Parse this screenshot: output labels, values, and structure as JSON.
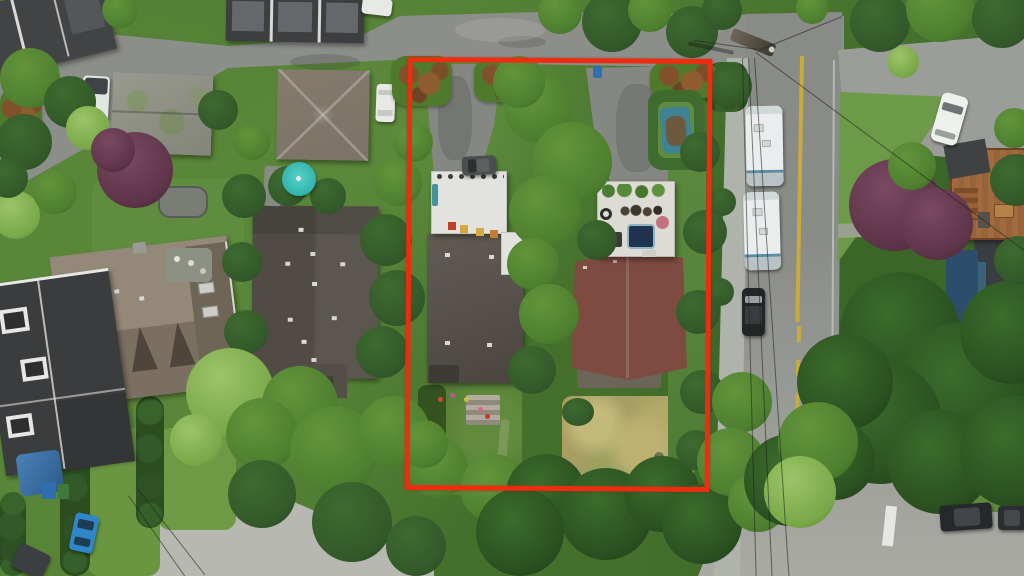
{
  "image": {
    "type": "aerial-drone-photograph",
    "subject": "residential lot assembly outlined in red, two houses with driveways, bordered by a street with parked RVs",
    "visible_text": "none"
  },
  "annotation": {
    "label": "property-boundary",
    "shape": "rectangle",
    "color": "#ee2d10",
    "x": 406,
    "y": 58,
    "width": 305,
    "height": 433
  },
  "palette": {
    "boundary": "#ee2d10",
    "roadTop": "#8c8e8a",
    "roadSide": "#979994",
    "concreteLane": "#b6b8b1",
    "sidewalk": "#b0b3ac",
    "parking": "#9b9d98",
    "yellowLine": "#c9aa3f",
    "asphaltDrive": "#858783",
    "whiteRoof": "#e2e3df",
    "deckWhite": "#dcdbd4",
    "leftHouseRoof": "#59534d",
    "rightHouseRoof": "#7d4b40",
    "neighborBigRoof": "#544f48",
    "steepRoof": "#948878",
    "modernBlackRoof": "#3a3c3d",
    "mossyRoof": "#8f9086",
    "pyramidRoof": "#7b7365",
    "navyWall": "#2d4d6d",
    "woodDeck": "#a26b3e",
    "rvWhite": "#e9edee",
    "grass": "#577f36",
    "dryLawn": "#a89e62",
    "treeDark": "#33592a",
    "treeMid": "#4e7f2f",
    "treeLight": "#78a848",
    "conifer": "#2c5222",
    "hedgePhotinia": "#4f7a2c",
    "maple": "#5e3448",
    "umbrellaTeal": "#2fb3ac",
    "hotTub": "#1f3350",
    "blueCar": "#2f86c8",
    "blueTarp": "#3f8294",
    "binBlue": "#2f6fb0"
  },
  "objects": [
    "red property boundary outline",
    "left subject house flat brown roof",
    "right subject house gabled red-brown roof",
    "white membrane garage roof with planter pots",
    "rooftop patio deck with hot tub and furniture",
    "two asphalt driveways",
    "blue boat under tarp inside hedge",
    "dry back lawn",
    "stepped garden with flower pots",
    "two white RV trailers parked on street",
    "black parked car",
    "white parked cars",
    "blue hatchback",
    "white vans",
    "neighbor pyramid-hip roof house",
    "neighbor mossy gray roof house",
    "neighbor large dark roof house",
    "neighbor steep shingle house with dormers",
    "modern black flat-roof house with skylights",
    "navy house with wood roof deck",
    "teal patio umbrella",
    "trampoline",
    "purple maple trees",
    "large conifer",
    "street with yellow centerline",
    "sidewalk",
    "utility pole with power lines",
    "photinia hedges",
    "crosswalk marking"
  ],
  "vegetation": [
    [
      30,
      78,
      30,
      "mid"
    ],
    [
      70,
      102,
      26,
      "dark"
    ],
    [
      24,
      142,
      28,
      "dark"
    ],
    [
      88,
      128,
      22,
      "light"
    ],
    [
      16,
      215,
      24,
      "light"
    ],
    [
      55,
      192,
      22,
      "mid"
    ],
    [
      8,
      178,
      20,
      "dark"
    ],
    [
      120,
      10,
      18,
      "mid"
    ],
    [
      135,
      170,
      38,
      "maple"
    ],
    [
      113,
      150,
      22,
      "maple"
    ],
    [
      218,
      110,
      20,
      "dark"
    ],
    [
      252,
      142,
      18,
      "mid"
    ],
    [
      288,
      186,
      20,
      "dark"
    ],
    [
      328,
      196,
      18,
      "dark"
    ],
    [
      244,
      196,
      22,
      "dark"
    ],
    [
      242,
      262,
      20,
      "dark"
    ],
    [
      246,
      332,
      22,
      "dark"
    ],
    [
      386,
      240,
      26,
      "dark"
    ],
    [
      397,
      298,
      28,
      "dark"
    ],
    [
      382,
      352,
      26,
      "dark"
    ],
    [
      398,
      182,
      24,
      "mid"
    ],
    [
      413,
      142,
      20,
      "mid"
    ],
    [
      230,
      392,
      44,
      "light"
    ],
    [
      300,
      404,
      38,
      "mid"
    ],
    [
      262,
      434,
      36,
      "mid"
    ],
    [
      334,
      450,
      44,
      "mid"
    ],
    [
      394,
      432,
      36,
      "mid"
    ],
    [
      196,
      440,
      26,
      "light"
    ],
    [
      262,
      494,
      34,
      "dark"
    ],
    [
      438,
      468,
      30,
      "mid"
    ],
    [
      494,
      488,
      34,
      "mid"
    ],
    [
      424,
      444,
      24,
      "mid"
    ],
    [
      546,
      494,
      40,
      "conifer"
    ],
    [
      606,
      514,
      46,
      "conifer"
    ],
    [
      662,
      494,
      38,
      "conifer"
    ],
    [
      702,
      524,
      40,
      "conifer"
    ],
    [
      520,
      532,
      44,
      "conifer"
    ],
    [
      352,
      522,
      40,
      "dark"
    ],
    [
      416,
      546,
      30,
      "dark"
    ],
    [
      538,
      108,
      34,
      "mid"
    ],
    [
      572,
      162,
      40,
      "mid"
    ],
    [
      545,
      212,
      36,
      "mid"
    ],
    [
      519,
      82,
      26,
      "mid"
    ],
    [
      597,
      240,
      20,
      "dark"
    ],
    [
      533,
      264,
      26,
      "mid"
    ],
    [
      549,
      314,
      30,
      "mid"
    ],
    [
      532,
      370,
      24,
      "dark"
    ],
    [
      700,
      152,
      20,
      "dark"
    ],
    [
      705,
      232,
      22,
      "dark"
    ],
    [
      698,
      312,
      22,
      "dark"
    ],
    [
      702,
      392,
      22,
      "dark"
    ],
    [
      696,
      450,
      20,
      "dark"
    ],
    [
      730,
      86,
      22,
      "dark"
    ],
    [
      722,
      202,
      14,
      "dark"
    ],
    [
      720,
      292,
      14,
      "dark"
    ],
    [
      742,
      402,
      30,
      "mid"
    ],
    [
      731,
      462,
      34,
      "mid"
    ],
    [
      758,
      502,
      30,
      "mid"
    ],
    [
      900,
      332,
      60,
      "conifer"
    ],
    [
      965,
      392,
      70,
      "conifer"
    ],
    [
      880,
      422,
      62,
      "conifer"
    ],
    [
      940,
      462,
      52,
      "conifer"
    ],
    [
      845,
      382,
      48,
      "conifer"
    ],
    [
      1012,
      332,
      52,
      "conifer"
    ],
    [
      1016,
      452,
      56,
      "conifer"
    ],
    [
      835,
      460,
      40,
      "conifer"
    ],
    [
      790,
      480,
      46,
      "conifer"
    ],
    [
      818,
      442,
      40,
      "mid"
    ],
    [
      800,
      492,
      36,
      "light"
    ],
    [
      880,
      22,
      30,
      "dark"
    ],
    [
      940,
      8,
      34,
      "mid"
    ],
    [
      1002,
      18,
      30,
      "dark"
    ],
    [
      903,
      62,
      16,
      "light"
    ],
    [
      812,
      8,
      16,
      "mid"
    ],
    [
      895,
      205,
      46,
      "maple"
    ],
    [
      937,
      224,
      36,
      "maple"
    ],
    [
      912,
      166,
      24,
      "mid"
    ],
    [
      560,
      12,
      22,
      "mid"
    ],
    [
      612,
      22,
      30,
      "dark"
    ],
    [
      650,
      10,
      22,
      "mid"
    ],
    [
      692,
      32,
      26,
      "dark"
    ],
    [
      722,
      10,
      20,
      "dark"
    ],
    [
      1016,
      180,
      26,
      "dark"
    ],
    [
      1018,
      260,
      24,
      "dark"
    ],
    [
      1014,
      128,
      20,
      "mid"
    ]
  ],
  "wires": [
    [
      742,
      58,
      520,
      -1.5,
      "v"
    ],
    [
      748,
      58,
      522,
      -2.6,
      "v"
    ],
    [
      754,
      58,
      524,
      -3.8,
      "v"
    ],
    [
      756,
      52,
      334,
      36.4,
      "h"
    ],
    [
      694,
      40,
      64,
      8,
      "h"
    ],
    [
      758,
      50,
      90,
      -22,
      "h"
    ],
    [
      128,
      496,
      100,
      -35,
      "v"
    ],
    [
      138,
      490,
      108,
      -38,
      "v"
    ]
  ]
}
